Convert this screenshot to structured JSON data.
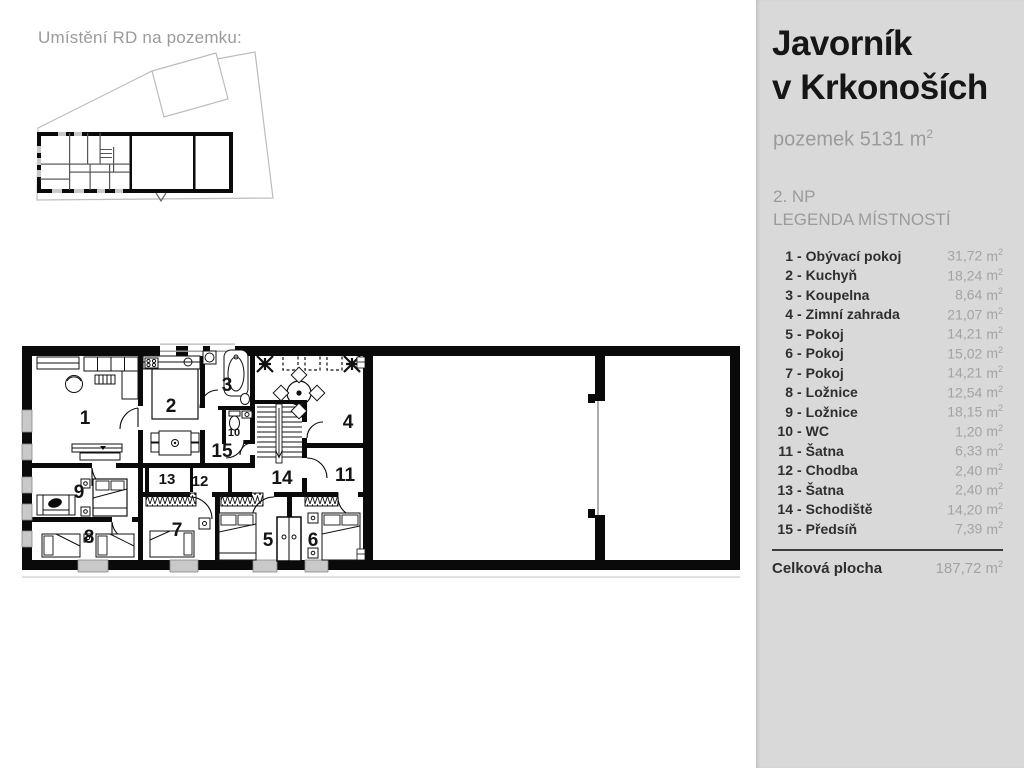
{
  "site": {
    "title": "Umístění RD na pozemku:"
  },
  "panel": {
    "title_line1": "Javorník",
    "title_line2": "v Krkonoších",
    "plot_label": "pozemek 5131 m",
    "plot_sup": "2",
    "floor": "2. NP",
    "legend_title": "LEGENDA MÍSTNOSTÍ",
    "compass_letter": "S",
    "footnote": "*Plocha místností je pouze orientační",
    "colors": {
      "panel_bg": "#d9d9d9",
      "muted_text": "#9b9b9b",
      "wall": "#0a0a0a"
    }
  },
  "legend": {
    "separator": "-",
    "unit": "m",
    "unit_sup": "2",
    "rooms": [
      {
        "num": "1",
        "name": "Obývací pokoj",
        "area": "31,72"
      },
      {
        "num": "2",
        "name": "Kuchyň",
        "area": "18,24"
      },
      {
        "num": "3",
        "name": "Koupelna",
        "area": "8,64"
      },
      {
        "num": "4",
        "name": "Zimní zahrada",
        "area": "21,07"
      },
      {
        "num": "5",
        "name": "Pokoj",
        "area": "14,21"
      },
      {
        "num": "6",
        "name": "Pokoj",
        "area": "15,02"
      },
      {
        "num": "7",
        "name": "Pokoj",
        "area": "14,21"
      },
      {
        "num": "8",
        "name": "Ložnice",
        "area": "12,54"
      },
      {
        "num": "9",
        "name": "Ložnice",
        "area": "18,15"
      },
      {
        "num": "10",
        "name": "WC",
        "area": "1,20"
      },
      {
        "num": "11",
        "name": "Šatna",
        "area": "6,33"
      },
      {
        "num": "12",
        "name": "Chodba",
        "area": "2,40"
      },
      {
        "num": "13",
        "name": "Šatna",
        "area": "2,40"
      },
      {
        "num": "14",
        "name": "Schodiště",
        "area": "14,20"
      },
      {
        "num": "15",
        "name": "Předsíň",
        "area": "7,39"
      }
    ],
    "total_label": "Celková plocha",
    "total_area": "187,72"
  }
}
